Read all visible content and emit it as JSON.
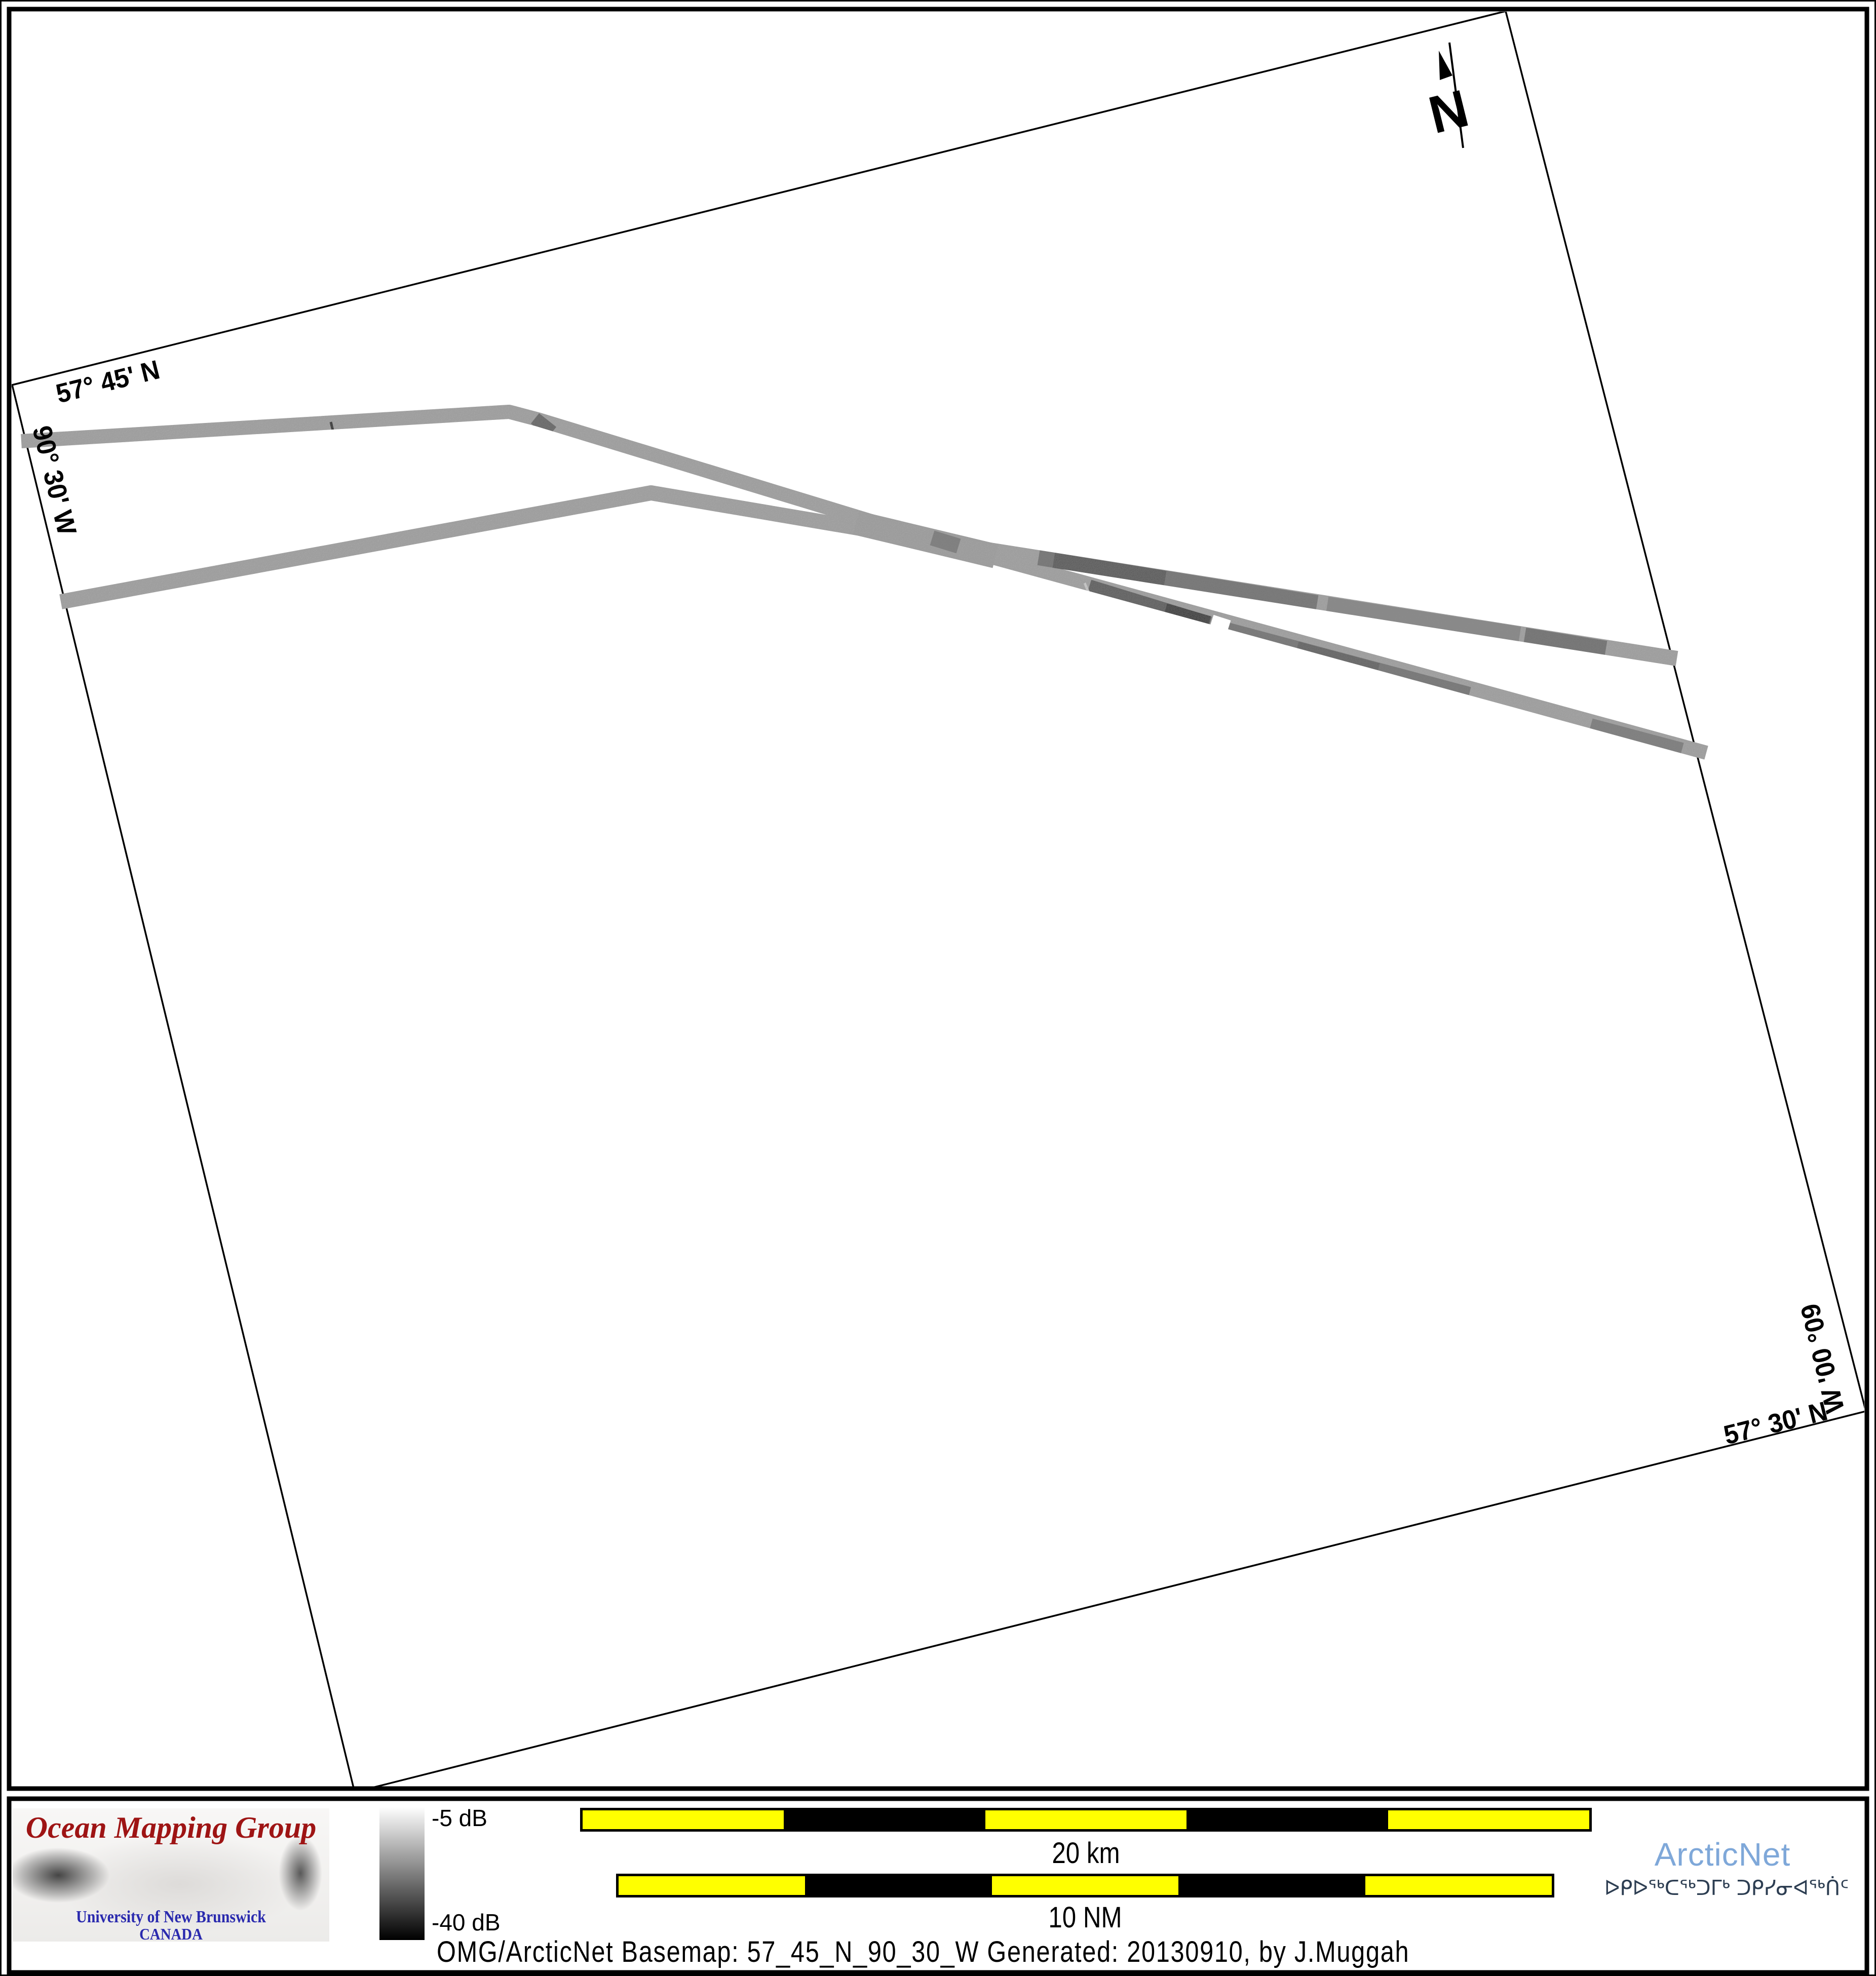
{
  "map": {
    "labels": {
      "top_lat": "57° 45' N",
      "left_lon": "90° 30' W",
      "right_lon": "90° 00' W",
      "bottom_lat": "57° 30' N"
    },
    "north_label": "N"
  },
  "legend": {
    "top_label": "-5 dB",
    "bottom_label": "-40 dB",
    "top_color": "#fefefe",
    "bottom_color": "#000000"
  },
  "scalebars": {
    "km": {
      "label": "20 km",
      "segments": [
        "#ffff00",
        "#000000",
        "#ffff00",
        "#000000",
        "#ffff00"
      ]
    },
    "nm": {
      "label": "10 NM",
      "segments": [
        "#ffff00",
        "#000000",
        "#ffff00",
        "#000000",
        "#ffff00"
      ]
    }
  },
  "branding": {
    "omg": {
      "title": "Ocean Mapping Group",
      "subtitle1": "University of New Brunswick",
      "subtitle2": "CANADA",
      "title_color": "#9e1414",
      "subtitle_color": "#2a2aae"
    },
    "arcticnet": {
      "name": "ArcticNet",
      "syllabics": "ᐅᑭᐅᖅᑕᖅᑐᒥᒃ ᑐᑭᓯᓂᐊᖅᑏᑦ",
      "name_color": "#7fa8d9",
      "syllabics_color": "#2d3e52"
    }
  },
  "footer": {
    "caption": "OMG/ArcticNet Basemap: 57_45_N_90_30_W    Generated: 20130910, by J.Muggah"
  }
}
